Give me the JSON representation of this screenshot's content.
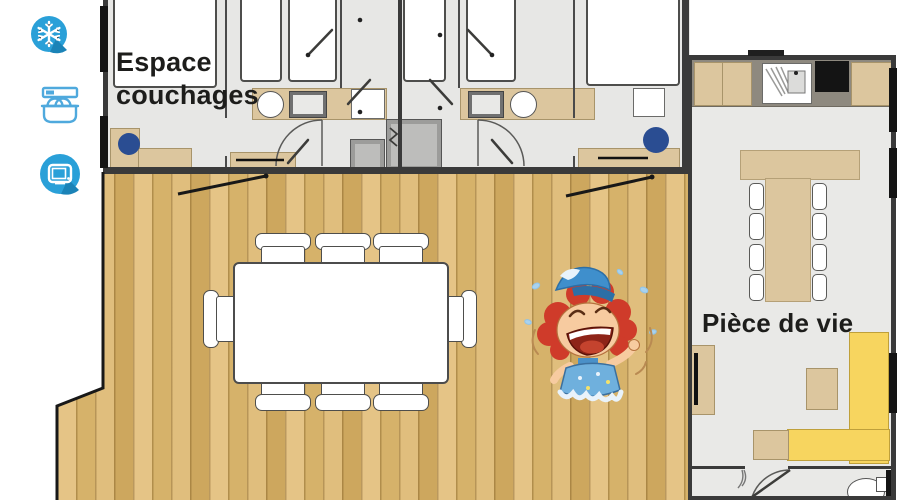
{
  "labels": {
    "sleeping_area": "Espace couchages",
    "living_area": "Pièce de vie"
  },
  "amenities": [
    {
      "id": "air-conditioning",
      "icon": "snowflake-icon",
      "style": "filled-circle-badge"
    },
    {
      "id": "dishwasher",
      "icon": "dishwasher-icon",
      "style": "outline"
    },
    {
      "id": "tv",
      "icon": "tv-icon",
      "style": "filled-circle-badge"
    }
  ],
  "colors": {
    "accent_blue": "#2aa0d8",
    "accent_blue_dark": "#1b83b7",
    "wall": "#3a3a3a",
    "interior_floor": "#e7e7e5",
    "deck_wood": "#dcb873",
    "furniture_wood": "#dcc69e",
    "sofa_yellow": "#f7d55f",
    "chair_blue": "#2a4d92",
    "label_text": "#1d1d1b"
  },
  "mascot": {
    "id": "laughing-splash-mascot"
  }
}
